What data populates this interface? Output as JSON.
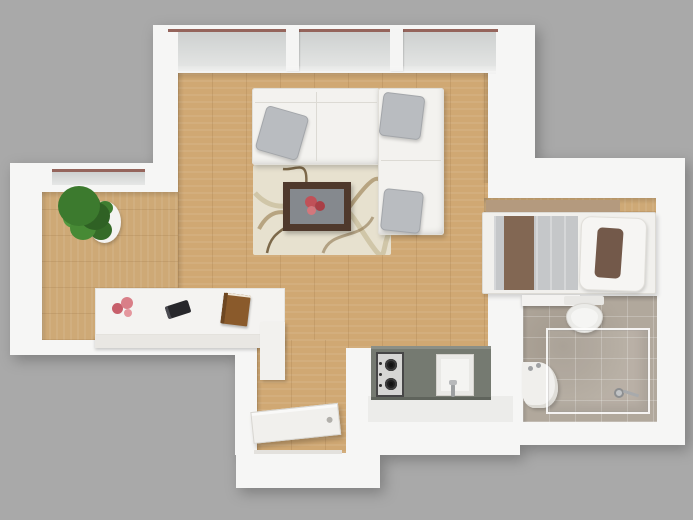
{
  "scene": {
    "type": "3D top-down floor plan render of a studio apartment",
    "background_color": "#a9a9a9",
    "rooms": [
      {
        "name": "living-room",
        "floor": "light oak wood",
        "furniture": [
          "l-shaped-sectional-sofa",
          "gray-throw-pillow-left",
          "gray-throw-pillow-corner",
          "gray-throw-pillow-chaise",
          "patterned-area-rug",
          "dark-wood-coffee-table",
          "red-flower-centerpiece"
        ]
      },
      {
        "name": "left-alcove",
        "floor": "light oak wood",
        "furniture": [
          "potted-green-plant",
          "white-plant-pot",
          "white-sideboard",
          "pink-flowers",
          "black-remote",
          "brown-book"
        ]
      },
      {
        "name": "bedroom",
        "floor": "light oak wood",
        "furniture": [
          "single-bed",
          "tan-headboard",
          "gray-duvet",
          "brown-blanket-runner",
          "white-pillow",
          "brown-accent-pillow"
        ]
      },
      {
        "name": "bathroom",
        "floor": "taupe-tile",
        "furniture": [
          "wall-shelf",
          "toilet",
          "corner-sink",
          "glass-shower-enclosure",
          "chrome-shower-fixture"
        ]
      },
      {
        "name": "kitchen",
        "floor": "white",
        "furniture": [
          "gray-counter",
          "two-burner-stove",
          "kitchen-sink",
          "chrome-faucet"
        ]
      },
      {
        "name": "entry",
        "floor": "light oak wood",
        "furniture": [
          "open-white-door"
        ]
      }
    ],
    "architecture": [
      "top-window-wall-three-panes",
      "left-wall-window",
      "white-walls"
    ],
    "palette": {
      "background": "#a9a9a9",
      "wall_white": "#f6f6f5",
      "wood_floor": "#d0a873",
      "tile_floor": "#b1a89c",
      "kitchen_counter": "#757a71",
      "window_glass": "#d7d9d8",
      "window_top_line": "#95655c",
      "sofa_white": "#f3f2ef",
      "pillow_gray": "#b9bcc0",
      "rug_cream": "#e7e1cf",
      "table_wood": "#4f392c",
      "flower_red": "#c4555a",
      "plant_green": "#3c7a2e",
      "duvet_gray": "#c5c7c9",
      "blanket_brown": "#826753",
      "accent_pillow_brown": "#73594a",
      "book_brown": "#8a5a2b"
    }
  }
}
